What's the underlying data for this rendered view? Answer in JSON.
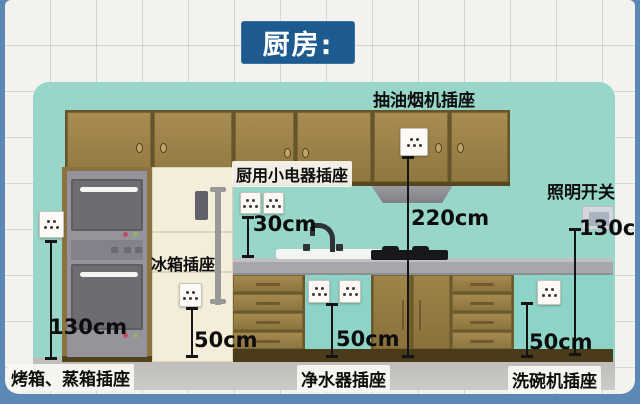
{
  "title": "厨房:",
  "annotations": {
    "range_hood": {
      "label": "抽油烟机插座",
      "height": "220cm"
    },
    "small_appliance": {
      "label": "厨用小电器插座",
      "height": "30cm"
    },
    "lighting": {
      "label": "照明开关",
      "height": "130cm"
    },
    "fridge": {
      "label": "冰箱插座",
      "height": "50cm"
    },
    "oven": {
      "label": "烤箱、蒸箱插座",
      "height": "130cm"
    },
    "water_purifier": {
      "label": "净水器插座",
      "height": "50cm"
    },
    "dishwasher": {
      "label": "洗碗机插座",
      "height": "50cm"
    }
  },
  "colors": {
    "frame_blue": "#5c88b5",
    "title_bg": "#1c5a8f",
    "wall_teal": "#98d6c9",
    "cabinet_brown": "#9b7e46",
    "counter_gray": "#a6a7aa",
    "appliance_gray": "#94949a",
    "fridge_cream": "#f3edda"
  }
}
